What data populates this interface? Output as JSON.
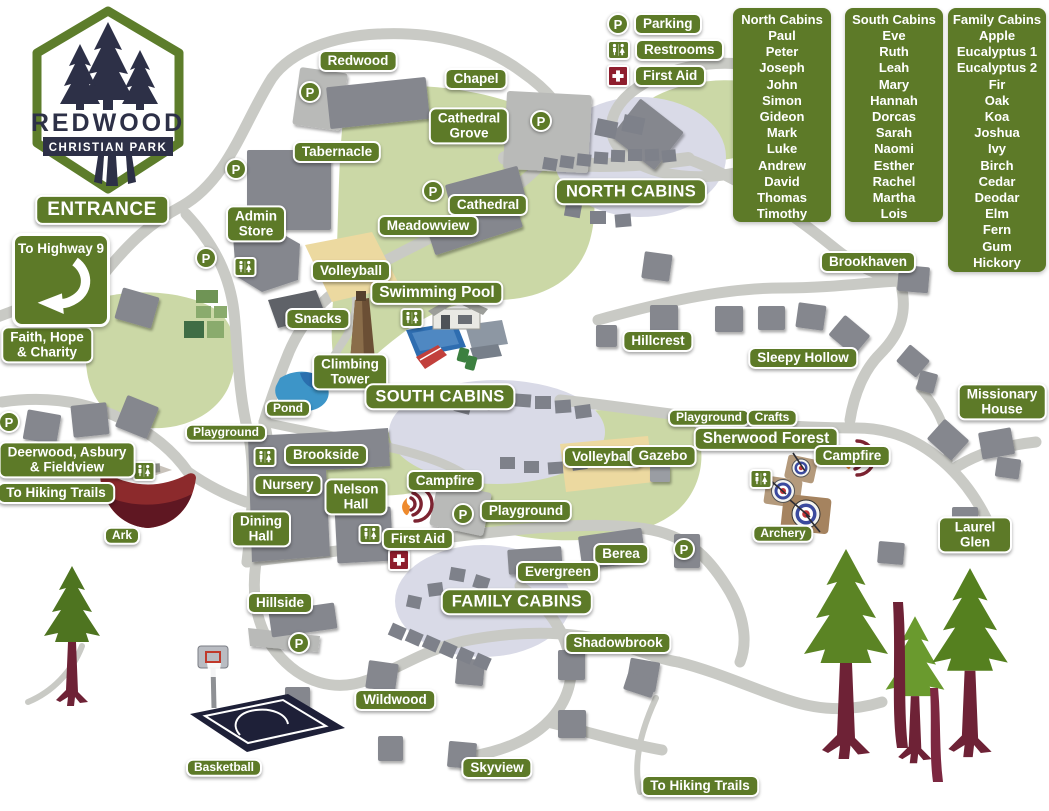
{
  "logo": {
    "line1": "REDWOOD",
    "line2": "CHRISTIAN PARK"
  },
  "legend": {
    "items": [
      {
        "id": "parking",
        "label": "Parking",
        "symbol": "P"
      },
      {
        "id": "restrooms",
        "label": "Restrooms"
      },
      {
        "id": "first-aid",
        "label": "First Aid"
      }
    ]
  },
  "cabin_lists": [
    {
      "title": "North Cabins",
      "x": 733,
      "y": 8,
      "w": 98,
      "h": 214,
      "names": [
        "Paul",
        "Peter",
        "Joseph",
        "John",
        "Simon",
        "Gideon",
        "Mark",
        "Luke",
        "Andrew",
        "David",
        "Thomas",
        "Timothy"
      ]
    },
    {
      "title": "South Cabins",
      "x": 845,
      "y": 8,
      "w": 98,
      "h": 214,
      "names": [
        "Eve",
        "Ruth",
        "Leah",
        "Mary",
        "Hannah",
        "Dorcas",
        "Sarah",
        "Naomi",
        "Esther",
        "Rachel",
        "Martha",
        "Lois"
      ]
    },
    {
      "title": "Family Cabins",
      "x": 948,
      "y": 8,
      "w": 98,
      "h": 264,
      "names": [
        "Apple",
        "Eucalyptus 1",
        "Eucalyptus 2",
        "Fir",
        "Oak",
        "Koa",
        "Joshua",
        "Ivy",
        "Birch",
        "Cedar",
        "Deodar",
        "Elm",
        "Fern",
        "Gum",
        "Hickory"
      ]
    }
  ],
  "map": {
    "highway_sign_text": "To Highway 9",
    "parking_symbol": "P",
    "labels": [
      {
        "text": "Redwood",
        "x": 358,
        "y": 61
      },
      {
        "text": "Chapel",
        "x": 476,
        "y": 79
      },
      {
        "text": "Cathedral\nGrove",
        "x": 469,
        "y": 126
      },
      {
        "text": "Tabernacle",
        "x": 337,
        "y": 152
      },
      {
        "text": "NORTH CABINS",
        "x": 631,
        "y": 192,
        "cls": "big"
      },
      {
        "text": "Cathedral",
        "x": 488,
        "y": 205
      },
      {
        "text": "Admin\nStore",
        "x": 256,
        "y": 224
      },
      {
        "text": "ENTRANCE",
        "x": 102,
        "y": 210,
        "cls": "entrance"
      },
      {
        "text": "Meadowview",
        "x": 428,
        "y": 226
      },
      {
        "text": "Brookhaven",
        "x": 868,
        "y": 262
      },
      {
        "text": "Volleyball",
        "x": 351,
        "y": 271
      },
      {
        "text": "Swimming Pool",
        "x": 437,
        "y": 293,
        "cls": "md"
      },
      {
        "text": "Snacks",
        "x": 318,
        "y": 319
      },
      {
        "text": "Faith, Hope\n& Charity",
        "x": 47,
        "y": 345
      },
      {
        "text": "Hillcrest",
        "x": 658,
        "y": 341
      },
      {
        "text": "Sleepy Hollow",
        "x": 803,
        "y": 358
      },
      {
        "text": "Climbing\nTower",
        "x": 350,
        "y": 372
      },
      {
        "text": "SOUTH CABINS",
        "x": 440,
        "y": 397,
        "cls": "big"
      },
      {
        "text": "Missionary\nHouse",
        "x": 1002,
        "y": 402
      },
      {
        "text": "Playground",
        "x": 709,
        "y": 418,
        "cls": "sm"
      },
      {
        "text": "Crafts",
        "x": 772,
        "y": 418,
        "cls": "sm"
      },
      {
        "text": "Pond",
        "x": 288,
        "y": 409,
        "cls": "sm"
      },
      {
        "text": "Playground",
        "x": 226,
        "y": 433,
        "cls": "sm"
      },
      {
        "text": "Sherwood Forest",
        "x": 766,
        "y": 439,
        "cls": "md"
      },
      {
        "text": "Deerwood, Asbury\n& Fieldview",
        "x": 67,
        "y": 460
      },
      {
        "text": "Brookside",
        "x": 326,
        "y": 455
      },
      {
        "text": "Volleyball",
        "x": 603,
        "y": 457
      },
      {
        "text": "Gazebo",
        "x": 663,
        "y": 456
      },
      {
        "text": "Campfire",
        "x": 852,
        "y": 456
      },
      {
        "text": "To Hiking Trails",
        "x": 56,
        "y": 493
      },
      {
        "text": "Nursery",
        "x": 288,
        "y": 485
      },
      {
        "text": "Nelson\nHall",
        "x": 356,
        "y": 497
      },
      {
        "text": "Campfire",
        "x": 445,
        "y": 481
      },
      {
        "text": "First Aid",
        "x": 418,
        "y": 539
      },
      {
        "text": "Playground",
        "x": 526,
        "y": 511
      },
      {
        "text": "Dining\nHall",
        "x": 261,
        "y": 529
      },
      {
        "text": "Archery",
        "x": 783,
        "y": 534,
        "cls": "sm"
      },
      {
        "text": "Ark",
        "x": 122,
        "y": 536,
        "cls": "sm"
      },
      {
        "text": "Berea",
        "x": 621,
        "y": 554
      },
      {
        "text": "Laurel Glen",
        "x": 975,
        "y": 535
      },
      {
        "text": "Evergreen",
        "x": 558,
        "y": 572
      },
      {
        "text": "FAMILY CABINS",
        "x": 517,
        "y": 602,
        "cls": "big"
      },
      {
        "text": "Hillside",
        "x": 280,
        "y": 603
      },
      {
        "text": "Shadowbrook",
        "x": 618,
        "y": 643
      },
      {
        "text": "Wildwood",
        "x": 395,
        "y": 700
      },
      {
        "text": "Basketball",
        "x": 224,
        "y": 768,
        "cls": "sm"
      },
      {
        "text": "Skyview",
        "x": 497,
        "y": 768
      },
      {
        "text": "To Hiking Trails",
        "x": 700,
        "y": 786
      }
    ],
    "parking_markers": [
      {
        "x": 310,
        "y": 92
      },
      {
        "x": 236,
        "y": 169
      },
      {
        "x": 433,
        "y": 191
      },
      {
        "x": 541,
        "y": 121
      },
      {
        "x": 206,
        "y": 258
      },
      {
        "x": 9,
        "y": 422
      },
      {
        "x": 463,
        "y": 514
      },
      {
        "x": 684,
        "y": 549
      },
      {
        "x": 299,
        "y": 643
      }
    ],
    "restroom_markers": [
      {
        "x": 412,
        "y": 318
      },
      {
        "x": 245,
        "y": 267
      },
      {
        "x": 265,
        "y": 457
      },
      {
        "x": 370,
        "y": 534
      },
      {
        "x": 144,
        "y": 471
      },
      {
        "x": 761,
        "y": 479
      }
    ],
    "first_aid_markers": [
      {
        "x": 399,
        "y": 560
      }
    ],
    "campfire_markers": [
      {
        "x": 420,
        "y": 504
      },
      {
        "x": 862,
        "y": 458
      }
    ]
  },
  "colors": {
    "label_green": "#5d7a28",
    "road_gray": "#c9cac5",
    "building_gray": "#85878e",
    "field_green": "#cbd8a6",
    "cabin_zone_lavender": "#d9dae7",
    "court_tan": "#ecd9a0",
    "pool_blue": "#2e6db0",
    "first_aid_red": "#8e1d2d",
    "tree_trunk_maroon": "#6e2236"
  }
}
